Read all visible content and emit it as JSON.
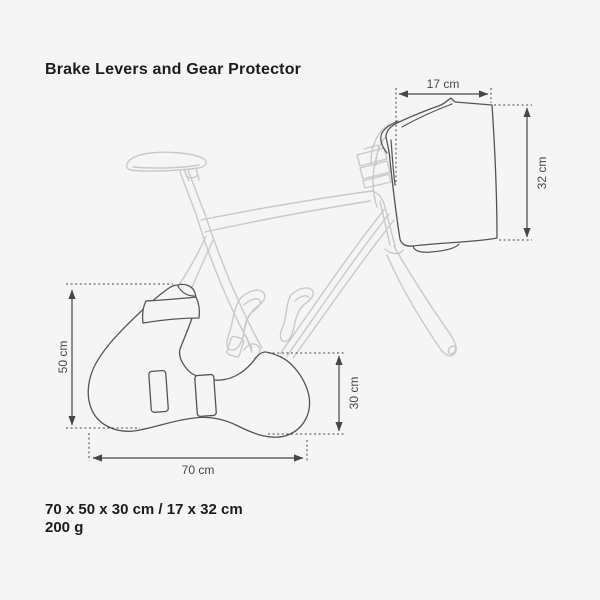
{
  "title": "Brake Levers and Gear Protector",
  "diagram": {
    "dimensions": [
      {
        "part": "brake-lever-cover",
        "label": "17 cm",
        "axis": "horizontal"
      },
      {
        "part": "brake-lever-cover",
        "label": "32 cm",
        "axis": "vertical"
      },
      {
        "part": "gear-protector-cover",
        "label": "50 cm",
        "axis": "vertical"
      },
      {
        "part": "gear-protector-cover",
        "label": "30 cm",
        "axis": "vertical"
      },
      {
        "part": "gear-protector-cover",
        "label": "70 cm",
        "axis": "horizontal"
      }
    ]
  },
  "specs": {
    "size_line": "70 x 50 x 30 cm / 17 x 32 cm",
    "weight_line": "200 g"
  },
  "colors": {
    "background": "#f5f5f5",
    "heading_text": "#1c1c1e",
    "dimension_lines": "#474747",
    "cover_outline": "#545454",
    "bicycle_outline": "#c9c9c9"
  }
}
